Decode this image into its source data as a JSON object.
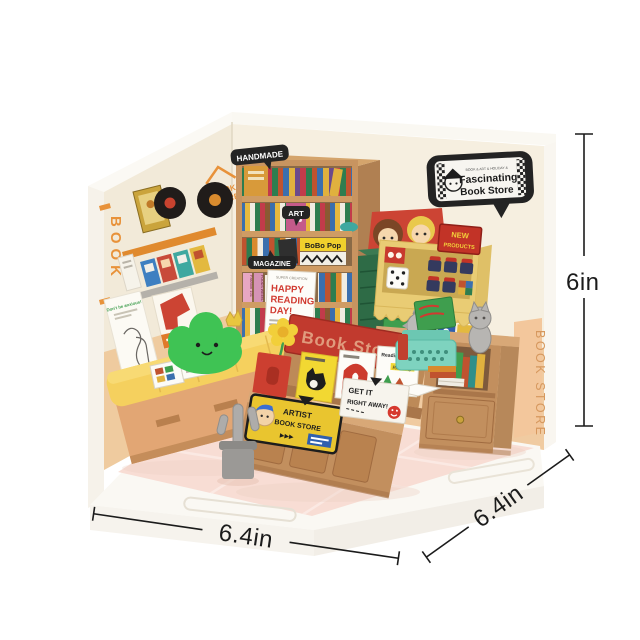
{
  "image": {
    "description": "Product photo of a DIY miniature book store room kit shown from the open corner, with printed size annotations",
    "background": "#ffffff"
  },
  "annotations": {
    "height": "6in",
    "width": "6.4in",
    "depth": "6.4in"
  },
  "signs": {
    "store_bubble": {
      "tagline": "BOOK & ART & HOLIDAY &",
      "line1": "Fascinating",
      "line2": "Book Store"
    },
    "handmade": "HANDMADE",
    "art": "ART",
    "magazine": "MAGAZINE",
    "bobo_pop": "BoBo Pop",
    "happy_poster": {
      "top": "SUPER CREATION",
      "line1": "HAPPY",
      "line2": "READING",
      "line3": "DAY!"
    },
    "counter_sign": "Book Store",
    "left_wall_vertical": "BOOK",
    "wall_decal_line1": "BOOK",
    "wall_decal_line2": "STORE",
    "anxious_poster": "Don't be anxious!",
    "new_products": {
      "line1": "NEW",
      "line2": "PRODUCTS"
    },
    "artist_sign": {
      "line1": "ARTIST",
      "line2": "BOOK STORE",
      "arrows": "▶▶▶"
    },
    "get_it": {
      "line1": "GET IT",
      "line2": "RIGHT AWAY!"
    },
    "right_wall_vertical": "BOOK STORE"
  },
  "books": {
    "reading_club": "Reading Club",
    "reading": "Reading",
    "fashion": "Fashion 101",
    "foods": "FOODS WEEKLY"
  },
  "colors": {
    "accent_orange": "#E8923A",
    "sign_black": "#242424",
    "sign_red": "#C13A2E",
    "hutch_yellow": "#E9CC74",
    "chest_green": "#2E6B46",
    "typewriter_mint": "#7ED3BF",
    "cushion_yellow": "#F5D05E",
    "plush_green": "#3FC354",
    "floor_pink": "#F8DDD4",
    "wood_tan": "#C28F5E",
    "wainscot_peach": "#F0CBA1",
    "dimension_line": "#1B1B1B"
  }
}
